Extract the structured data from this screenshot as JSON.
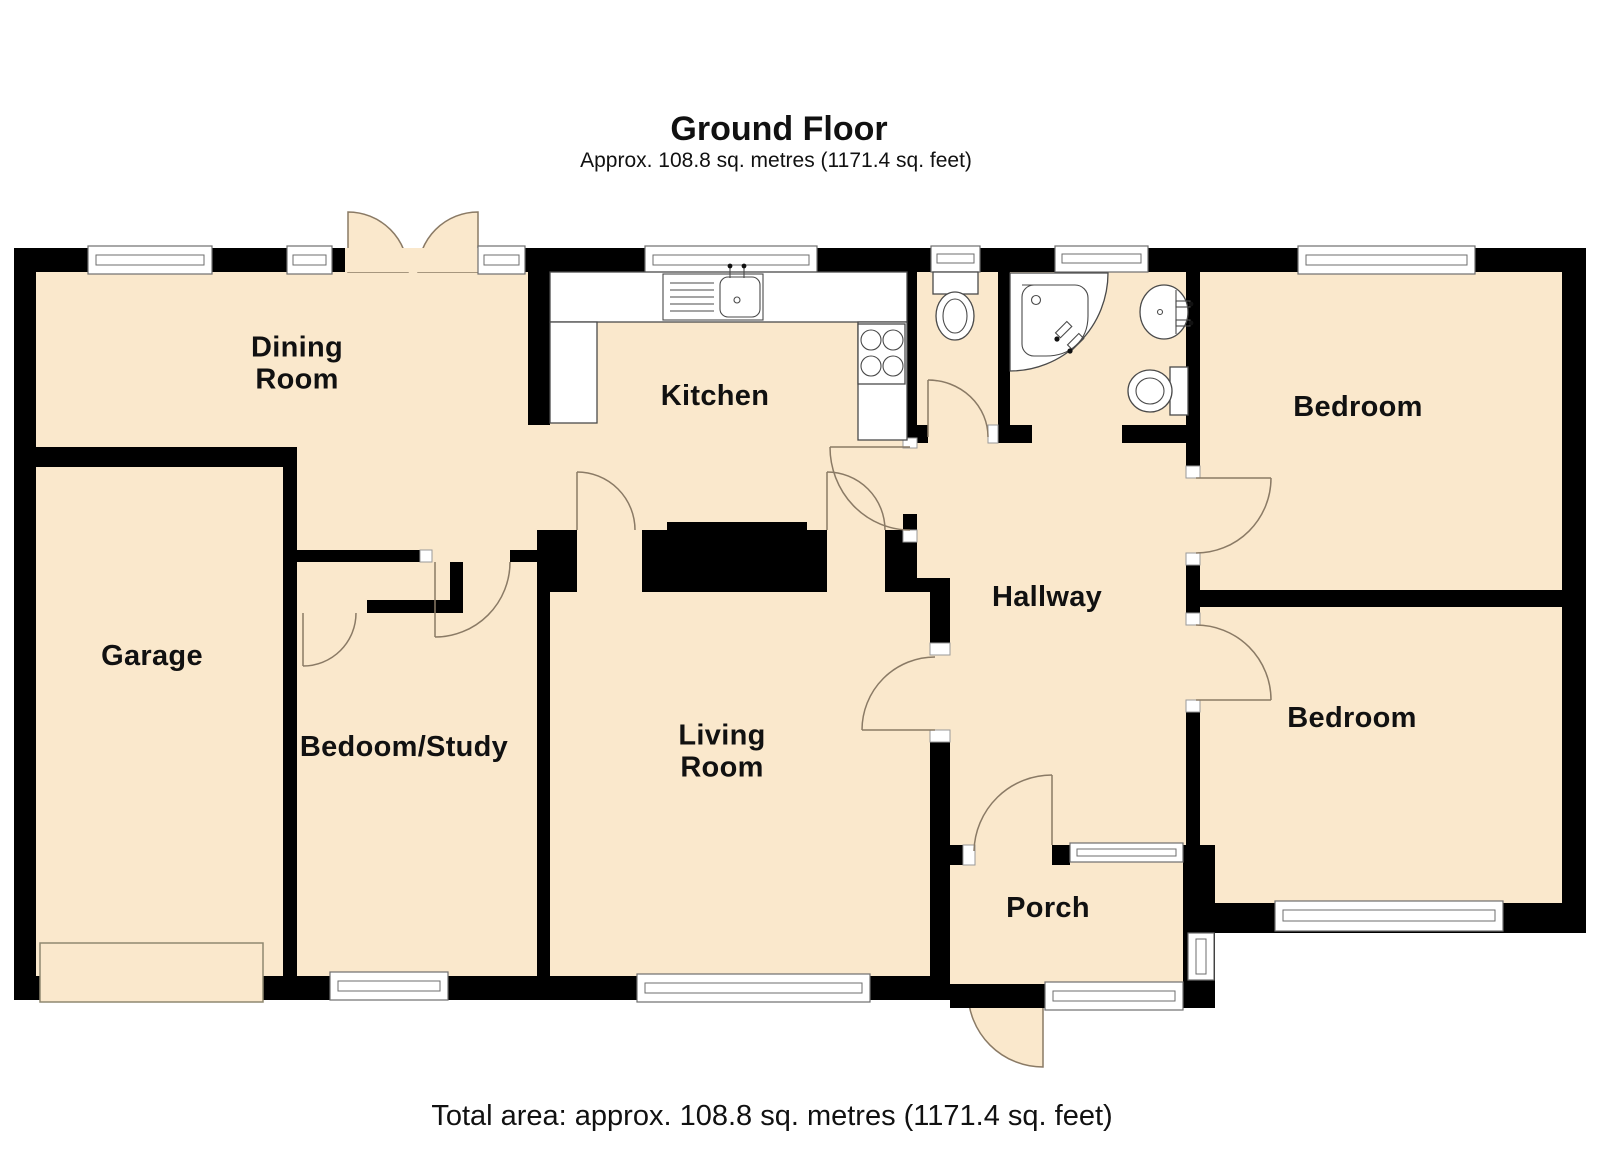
{
  "title": {
    "heading": "Ground Floor",
    "subtitle": "Approx. 108.8 sq. metres (1171.4 sq. feet)"
  },
  "footer": {
    "total_area": "Total area: approx. 108.8 sq. metres (1171.4 sq. feet)"
  },
  "rooms": [
    {
      "label": "Dining\nRoom"
    },
    {
      "label": "Kitchen"
    },
    {
      "label": "Garage"
    },
    {
      "label": "Bedoom/Study"
    },
    {
      "label": "Living\nRoom"
    },
    {
      "label": "Hallway"
    },
    {
      "label": "Porch"
    },
    {
      "label": "Bedroom"
    },
    {
      "label": "Bedroom"
    }
  ],
  "fixtures": [
    "kitchen-sink",
    "drainer",
    "hob",
    "wc-cistern",
    "wc-toilet",
    "corner-bath",
    "basin",
    "bathroom-toilet",
    "garage-door",
    "chimney-breast",
    "closet",
    "french-doors",
    "front-door"
  ],
  "colors": {
    "floor": "#FAE8CC",
    "wall": "#000000",
    "door_arc": "#8A7A65",
    "fixture_stroke": "#4A4A4A",
    "window_stroke": "#6E6E6E",
    "text": "#111111"
  }
}
